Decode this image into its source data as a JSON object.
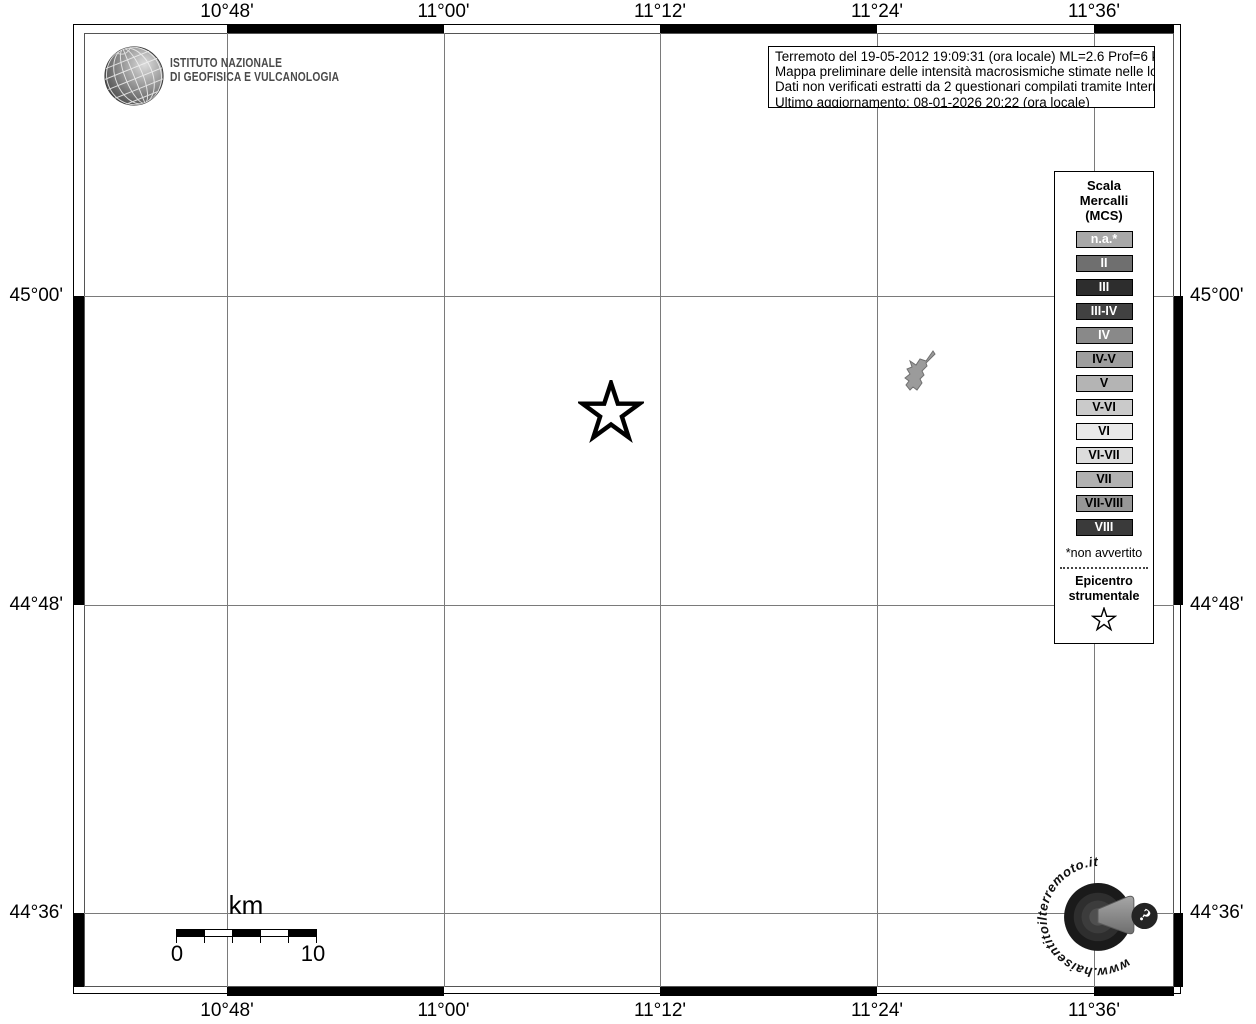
{
  "axis": {
    "top_labels": [
      "10°48'",
      "11°00'",
      "11°12'",
      "11°24'",
      "11°36'"
    ],
    "bottom_labels": [
      "10°48'",
      "11°00'",
      "11°12'",
      "11°24'",
      "11°36'"
    ],
    "left_labels": [
      "45°00'",
      "44°48'",
      "44°36'"
    ],
    "right_labels": [
      "45°00'",
      "44°48'",
      "44°36'"
    ]
  },
  "ingv": {
    "line1": "ISTITUTO NAZIONALE",
    "line2": "DI GEOFISICA E VULCANOLOGIA"
  },
  "info_box": {
    "lines": [
      "Terremoto del 19-05-2012 19:09:31 (ora locale) ML=2.6 Prof=6 km",
      "Mappa preliminare delle intensità macrosismiche stimate nelle località",
      "Dati non verificati estratti da 2 questionari compilati tramite Internet.",
      "Ultimo aggiornamento: 08-01-2026 20:22 (ora locale)"
    ]
  },
  "legend": {
    "title_lines": [
      "Scala",
      "Mercalli",
      "(MCS)"
    ],
    "items": [
      {
        "label": "n.a.*",
        "color": "#a8a8a8",
        "text": "#ffffff"
      },
      {
        "label": "II",
        "color": "#6f6f6f",
        "text": "#ffffff"
      },
      {
        "label": "III",
        "color": "#2d2d2d",
        "text": "#ffffff"
      },
      {
        "label": "III-IV",
        "color": "#414141",
        "text": "#ffffff"
      },
      {
        "label": "IV",
        "color": "#898989",
        "text": "#ffffff"
      },
      {
        "label": "IV-V",
        "color": "#9e9e9e",
        "text": "#000000"
      },
      {
        "label": "V",
        "color": "#b4b4b4",
        "text": "#000000"
      },
      {
        "label": "V-VI",
        "color": "#cacaca",
        "text": "#000000"
      },
      {
        "label": "VI",
        "color": "#e9e9e9",
        "text": "#000000"
      },
      {
        "label": "VI-VII",
        "color": "#dcdcdc",
        "text": "#000000"
      },
      {
        "label": "VII",
        "color": "#b1b1b1",
        "text": "#000000"
      },
      {
        "label": "VII-VIII",
        "color": "#979797",
        "text": "#000000"
      },
      {
        "label": "VIII",
        "color": "#3a3a3a",
        "text": "#ffffff"
      }
    ],
    "footnote": "*non avvertito",
    "epicenter_lines": [
      "Epicentro",
      "strumentale"
    ]
  },
  "scale_bar": {
    "unit": "km",
    "start_label": "0",
    "end_label": "10"
  },
  "badge": {
    "circle_text": "www.haisentitoilterremoto.it",
    "question_mark": "?"
  },
  "colors": {
    "map_background": "#ffffff",
    "gridline": "#7a7a7a",
    "locality_fill": "#9b9b9b",
    "locality_stroke": "#707070"
  }
}
